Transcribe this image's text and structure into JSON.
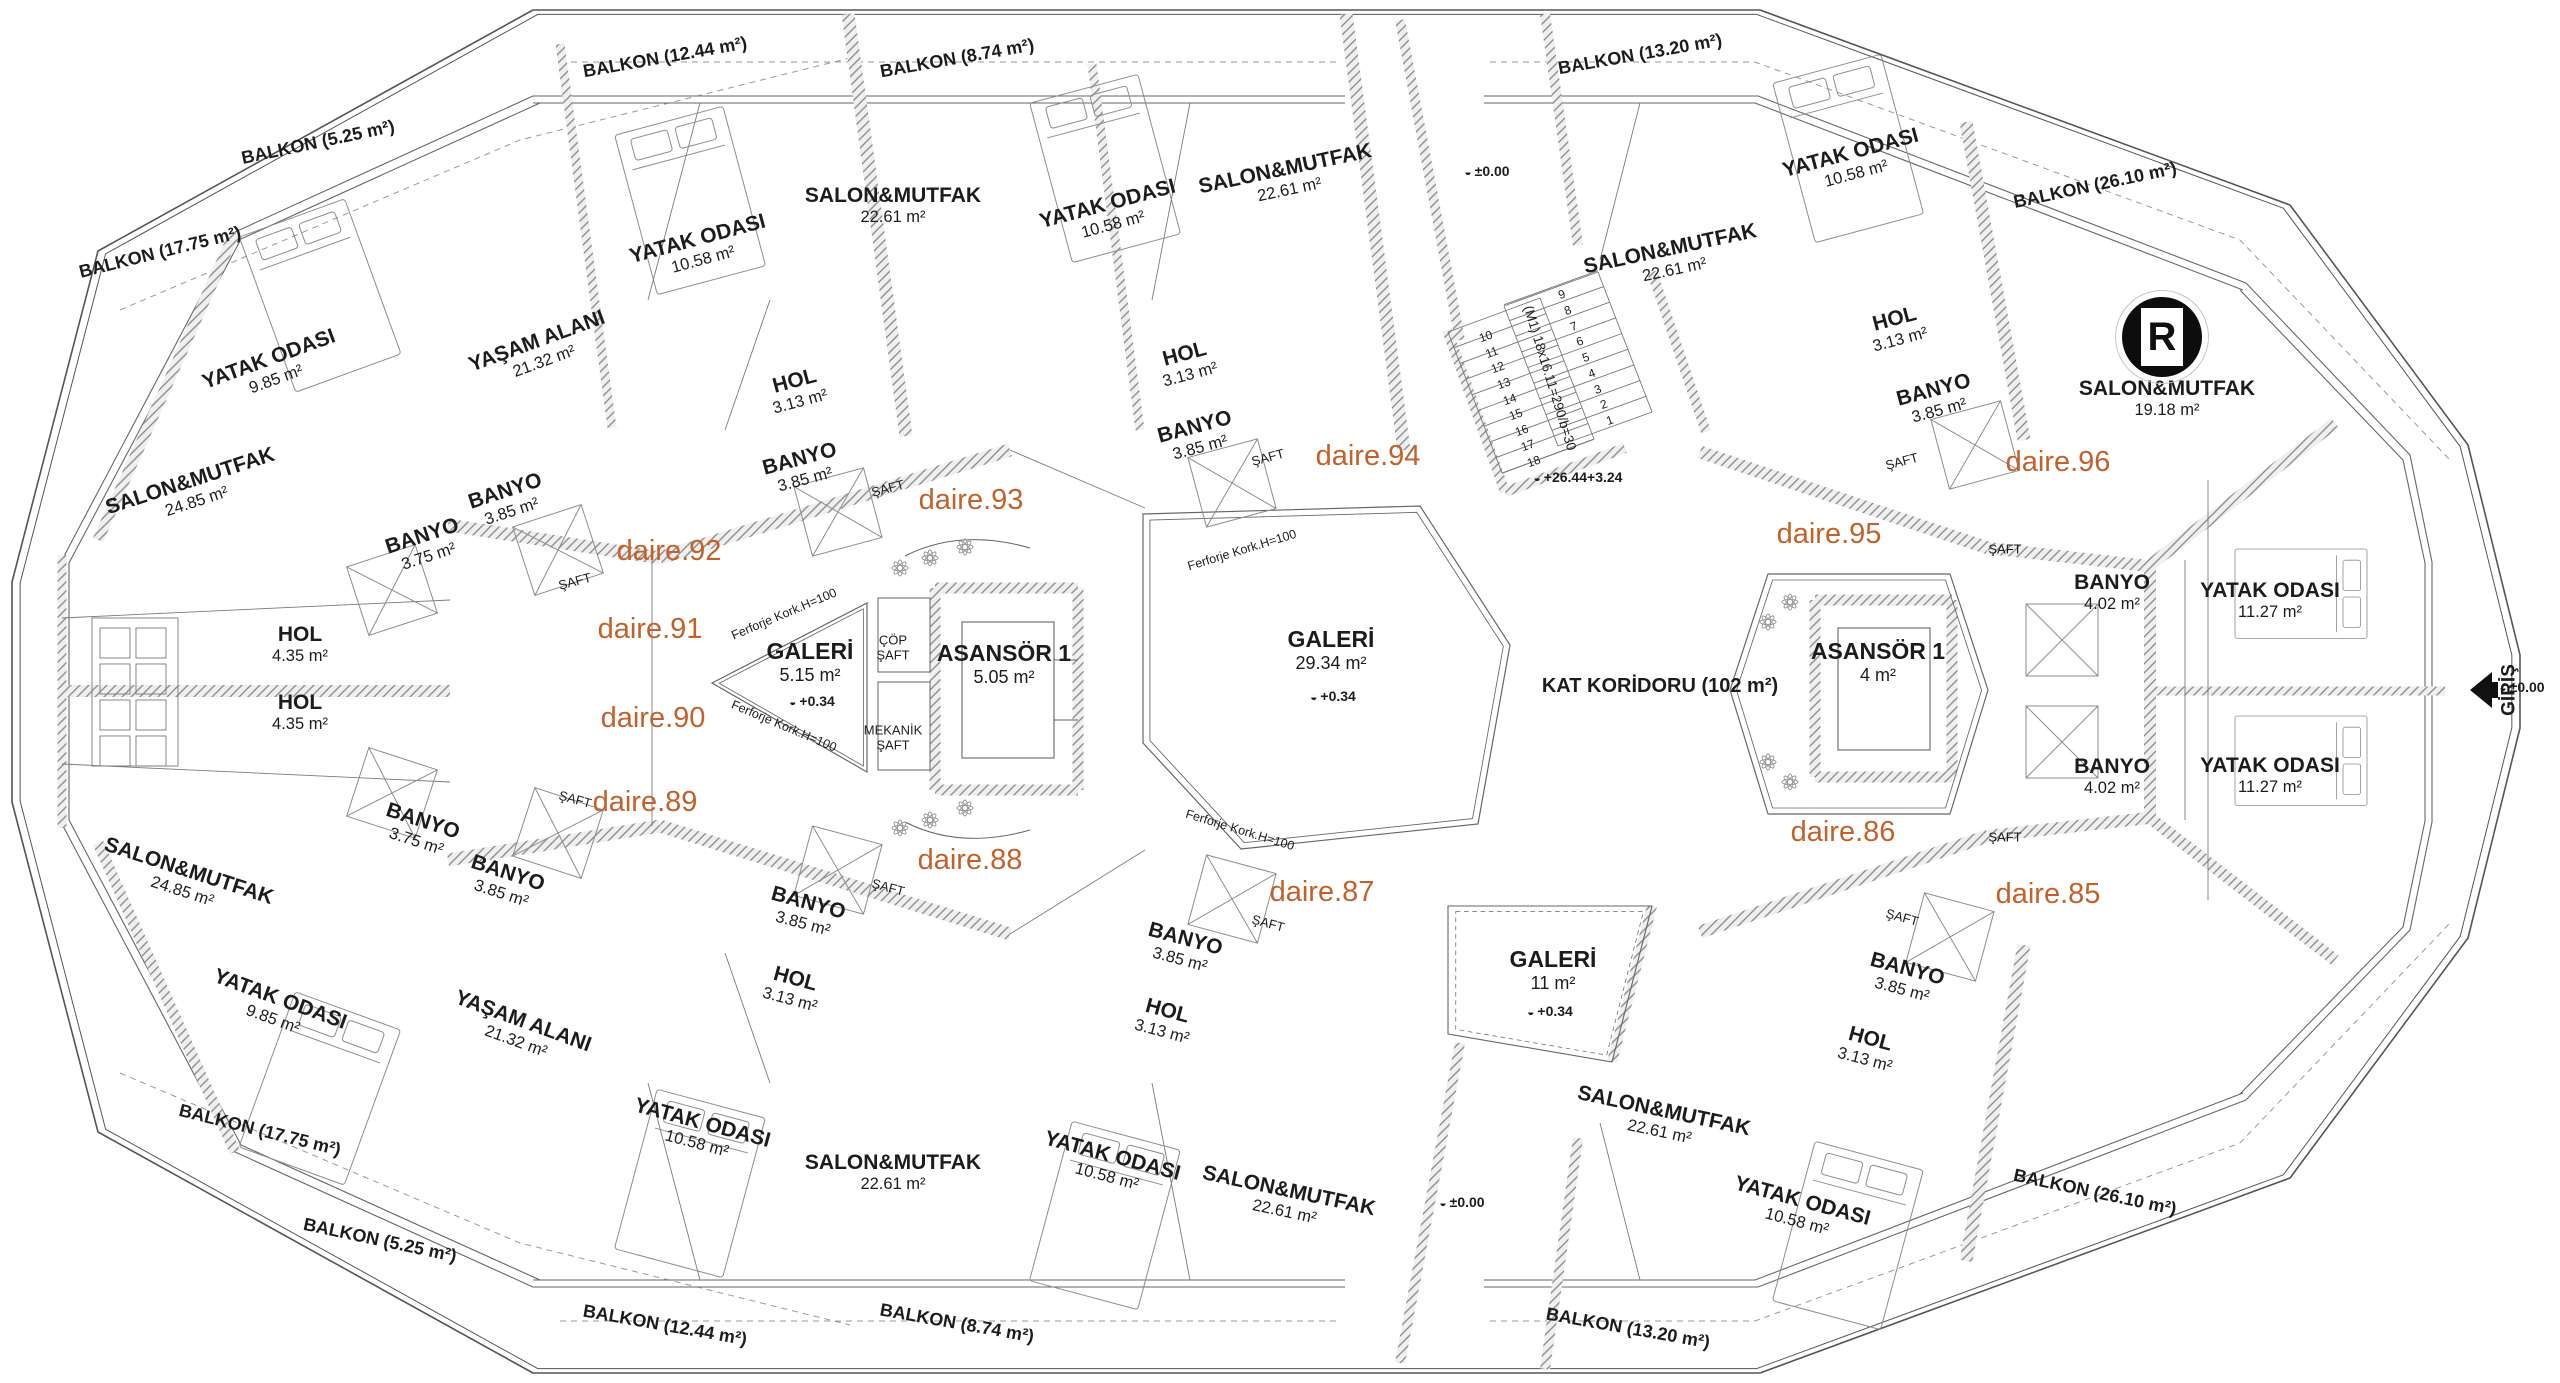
{
  "colors": {
    "accent": "#c2612c",
    "ink": "#1c1c1c",
    "wall": "#8f8f8f"
  },
  "logo": {
    "letter": "R"
  },
  "entrance": {
    "label": "GİRİŞ",
    "elevation": "±0.00"
  },
  "stairs": {
    "note": "(M1) 18x16.11=290/b=30"
  },
  "labels": [
    {
      "c": "room",
      "x": 272,
      "y": 368,
      "r": -20,
      "lines": [
        "YATAK ODASI",
        "9.85 m²"
      ]
    },
    {
      "c": "room",
      "x": 540,
      "y": 350,
      "r": -20,
      "lines": [
        "YAŞAM ALANI",
        "21.32 m²"
      ]
    },
    {
      "c": "room",
      "x": 193,
      "y": 490,
      "r": -18,
      "lines": [
        "SALON&MUTFAK",
        "24.85 m²"
      ]
    },
    {
      "c": "room",
      "x": 425,
      "y": 545,
      "r": -18,
      "lines": [
        "BANYO",
        "3.75 m²"
      ]
    },
    {
      "c": "room",
      "x": 508,
      "y": 500,
      "r": -18,
      "lines": [
        "BANYO",
        "3.85 m²"
      ]
    },
    {
      "c": "room",
      "x": 700,
      "y": 248,
      "r": -15,
      "lines": [
        "YATAK ODASI",
        "10.58 m²"
      ]
    },
    {
      "c": "room",
      "x": 893,
      "y": 205,
      "r": 0,
      "lines": [
        "SALON&MUTFAK",
        "22.61 m²"
      ]
    },
    {
      "c": "room",
      "x": 797,
      "y": 390,
      "r": -15,
      "lines": [
        "HOL",
        "3.13 m²"
      ]
    },
    {
      "c": "room",
      "x": 802,
      "y": 468,
      "r": -15,
      "lines": [
        "BANYO",
        "3.85 m²"
      ]
    },
    {
      "c": "room",
      "x": 1110,
      "y": 213,
      "r": -15,
      "lines": [
        "YATAK ODASI",
        "10.58 m²"
      ]
    },
    {
      "c": "room",
      "x": 1287,
      "y": 178,
      "r": -12,
      "lines": [
        "SALON&MUTFAK",
        "22.61 m²"
      ]
    },
    {
      "c": "room",
      "x": 1187,
      "y": 363,
      "r": -15,
      "lines": [
        "HOL",
        "3.13 m²"
      ]
    },
    {
      "c": "room",
      "x": 1197,
      "y": 436,
      "r": -15,
      "lines": [
        "BANYO",
        "3.85 m²"
      ]
    },
    {
      "c": "room",
      "x": 1672,
      "y": 258,
      "r": -12,
      "lines": [
        "SALON&MUTFAK",
        "22.61 m²"
      ]
    },
    {
      "c": "room",
      "x": 1853,
      "y": 162,
      "r": -15,
      "lines": [
        "YATAK ODASI",
        "10.58 m²"
      ]
    },
    {
      "c": "room",
      "x": 1897,
      "y": 328,
      "r": -15,
      "lines": [
        "HOL",
        "3.13 m²"
      ]
    },
    {
      "c": "room",
      "x": 1936,
      "y": 399,
      "r": -15,
      "lines": [
        "BANYO",
        "3.85 m²"
      ]
    },
    {
      "c": "room",
      "x": 2167,
      "y": 398,
      "r": 0,
      "lines": [
        "SALON&MUTFAK",
        "19.18 m²"
      ]
    },
    {
      "c": "room",
      "x": 2112,
      "y": 592,
      "r": 0,
      "lines": [
        "BANYO",
        "4.02 m²"
      ]
    },
    {
      "c": "room",
      "x": 2270,
      "y": 600,
      "r": 0,
      "lines": [
        "YATAK ODASI",
        "11.27 m²"
      ]
    },
    {
      "c": "room",
      "x": 2112,
      "y": 776,
      "r": 0,
      "lines": [
        "BANYO",
        "4.02 m²"
      ]
    },
    {
      "c": "room",
      "x": 2270,
      "y": 775,
      "r": 0,
      "lines": [
        "YATAK ODASI",
        "11.27 m²"
      ]
    },
    {
      "c": "room",
      "x": 300,
      "y": 644,
      "r": 0,
      "lines": [
        "HOL",
        "4.35 m²"
      ]
    },
    {
      "c": "room",
      "x": 300,
      "y": 712,
      "r": 0,
      "lines": [
        "HOL",
        "4.35 m²"
      ]
    },
    {
      "c": "room",
      "x": 277,
      "y": 1008,
      "r": 20,
      "lines": [
        "YATAK ODASI",
        "9.85 m²"
      ]
    },
    {
      "c": "room",
      "x": 520,
      "y": 1030,
      "r": 20,
      "lines": [
        "YAŞAM ALANI",
        "21.32 m²"
      ]
    },
    {
      "c": "room",
      "x": 186,
      "y": 880,
      "r": 18,
      "lines": [
        "SALON&MUTFAK",
        "24.85 m²"
      ]
    },
    {
      "c": "room",
      "x": 420,
      "y": 830,
      "r": 18,
      "lines": [
        "BANYO",
        "3.75 m²"
      ]
    },
    {
      "c": "room",
      "x": 505,
      "y": 882,
      "r": 18,
      "lines": [
        "BANYO",
        "3.85 m²"
      ]
    },
    {
      "c": "room",
      "x": 700,
      "y": 1132,
      "r": 15,
      "lines": [
        "YATAK ODASI",
        "10.58 m²"
      ]
    },
    {
      "c": "room",
      "x": 893,
      "y": 1172,
      "r": 0,
      "lines": [
        "SALON&MUTFAK",
        "22.61 m²"
      ]
    },
    {
      "c": "room",
      "x": 793,
      "y": 988,
      "r": 15,
      "lines": [
        "HOL",
        "3.13 m²"
      ]
    },
    {
      "c": "room",
      "x": 806,
      "y": 912,
      "r": 15,
      "lines": [
        "BANYO",
        "3.85 m²"
      ]
    },
    {
      "c": "room",
      "x": 1110,
      "y": 1165,
      "r": 15,
      "lines": [
        "YATAK ODASI",
        "10.58 m²"
      ]
    },
    {
      "c": "room",
      "x": 1287,
      "y": 1200,
      "r": 12,
      "lines": [
        "SALON&MUTFAK",
        "22.61 m²"
      ]
    },
    {
      "c": "room",
      "x": 1165,
      "y": 1020,
      "r": 15,
      "lines": [
        "HOL",
        "3.13 m²"
      ]
    },
    {
      "c": "room",
      "x": 1183,
      "y": 948,
      "r": 15,
      "lines": [
        "BANYO",
        "3.85 m²"
      ]
    },
    {
      "c": "room",
      "x": 1662,
      "y": 1120,
      "r": 12,
      "lines": [
        "SALON&MUTFAK",
        "22.61 m²"
      ]
    },
    {
      "c": "room",
      "x": 1800,
      "y": 1210,
      "r": 15,
      "lines": [
        "YATAK ODASI",
        "10.58 m²"
      ]
    },
    {
      "c": "room",
      "x": 1868,
      "y": 1048,
      "r": 15,
      "lines": [
        "HOL",
        "3.13 m²"
      ]
    },
    {
      "c": "room",
      "x": 1905,
      "y": 978,
      "r": 15,
      "lines": [
        "BANYO",
        "3.85 m²"
      ]
    },
    {
      "c": "core",
      "x": 810,
      "y": 662,
      "r": 0,
      "lines": [
        "GALERİ",
        "5.15 m²"
      ]
    },
    {
      "c": "elev",
      "x": 812,
      "y": 702,
      "r": 0,
      "lines": [
        "+0.34"
      ]
    },
    {
      "c": "shaftlbl",
      "x": 893,
      "y": 648,
      "r": 0,
      "lines": [
        "ÇÖP",
        "ŞAFT"
      ]
    },
    {
      "c": "shaftlbl",
      "x": 893,
      "y": 738,
      "r": 0,
      "lines": [
        "MEKANİK",
        "ŞAFT"
      ]
    },
    {
      "c": "core",
      "x": 1004,
      "y": 664,
      "r": 0,
      "lines": [
        "ASANSÖR 1",
        "5.05 m²"
      ]
    },
    {
      "c": "core",
      "x": 1331,
      "y": 650,
      "r": 0,
      "lines": [
        "GALERİ",
        "29.34 m²"
      ]
    },
    {
      "c": "elev",
      "x": 1333,
      "y": 697,
      "r": 0,
      "lines": [
        "+0.34"
      ]
    },
    {
      "c": "kat",
      "x": 1660,
      "y": 686,
      "r": 0,
      "lines": [
        "KAT KORİDORU (102 m²)"
      ]
    },
    {
      "c": "core",
      "x": 1878,
      "y": 662,
      "r": 0,
      "lines": [
        "ASANSÖR 1",
        "4 m²"
      ]
    },
    {
      "c": "core",
      "x": 1553,
      "y": 970,
      "r": 0,
      "lines": [
        "GALERİ",
        "11 m²"
      ]
    },
    {
      "c": "elev",
      "x": 1550,
      "y": 1012,
      "r": 0,
      "lines": [
        "+0.34"
      ]
    },
    {
      "c": "apt",
      "x": 669,
      "y": 551,
      "r": 0,
      "lines": [
        "daire.92"
      ]
    },
    {
      "c": "apt",
      "x": 650,
      "y": 629,
      "r": 0,
      "lines": [
        "daire.91"
      ]
    },
    {
      "c": "apt",
      "x": 653,
      "y": 718,
      "r": 0,
      "lines": [
        "daire.90"
      ]
    },
    {
      "c": "apt",
      "x": 645,
      "y": 802,
      "r": 0,
      "lines": [
        "daire.89"
      ]
    },
    {
      "c": "apt",
      "x": 971,
      "y": 500,
      "r": 0,
      "lines": [
        "daire.93"
      ]
    },
    {
      "c": "apt",
      "x": 970,
      "y": 860,
      "r": 0,
      "lines": [
        "daire.88"
      ]
    },
    {
      "c": "apt",
      "x": 1368,
      "y": 456,
      "r": 0,
      "lines": [
        "daire.94"
      ]
    },
    {
      "c": "apt",
      "x": 1322,
      "y": 892,
      "r": 0,
      "lines": [
        "daire.87"
      ]
    },
    {
      "c": "apt",
      "x": 1829,
      "y": 534,
      "r": 0,
      "lines": [
        "daire.95"
      ]
    },
    {
      "c": "apt",
      "x": 1843,
      "y": 832,
      "r": 0,
      "lines": [
        "daire.86"
      ]
    },
    {
      "c": "apt",
      "x": 2058,
      "y": 462,
      "r": 0,
      "lines": [
        "daire.96"
      ]
    },
    {
      "c": "apt",
      "x": 2048,
      "y": 894,
      "r": 0,
      "lines": [
        "daire.85"
      ]
    },
    {
      "c": "balk",
      "x": 665,
      "y": 57,
      "r": -10,
      "lines": [
        "BALKON (12.44 m²)"
      ]
    },
    {
      "c": "balk",
      "x": 957,
      "y": 58,
      "r": -10,
      "lines": [
        "BALKON (8.74 m²)"
      ]
    },
    {
      "c": "balk",
      "x": 1640,
      "y": 54,
      "r": -10,
      "lines": [
        "BALKON (13.20 m²)"
      ]
    },
    {
      "c": "balk",
      "x": 318,
      "y": 142,
      "r": -12,
      "lines": [
        "BALKON (5.25 m²)"
      ]
    },
    {
      "c": "balk",
      "x": 160,
      "y": 252,
      "r": -14,
      "lines": [
        "BALKON (17.75 m²)"
      ]
    },
    {
      "c": "balk",
      "x": 2095,
      "y": 185,
      "r": -12,
      "lines": [
        "BALKON (26.10 m²)"
      ]
    },
    {
      "c": "balk",
      "x": 665,
      "y": 1325,
      "r": 10,
      "lines": [
        "BALKON (12.44 m²)"
      ]
    },
    {
      "c": "balk",
      "x": 957,
      "y": 1323,
      "r": 10,
      "lines": [
        "BALKON (8.74 m²)"
      ]
    },
    {
      "c": "balk",
      "x": 1628,
      "y": 1328,
      "r": 10,
      "lines": [
        "BALKON (13.20 m²)"
      ]
    },
    {
      "c": "balk",
      "x": 380,
      "y": 1240,
      "r": 12,
      "lines": [
        "BALKON (5.25 m²)"
      ]
    },
    {
      "c": "balk",
      "x": 260,
      "y": 1130,
      "r": 14,
      "lines": [
        "BALKON (17.75 m²)"
      ]
    },
    {
      "c": "balk",
      "x": 2095,
      "y": 1192,
      "r": 12,
      "lines": [
        "BALKON (26.10 m²)"
      ]
    },
    {
      "c": "shaft",
      "x": 575,
      "y": 582,
      "r": -15,
      "lines": [
        "ŞAFT"
      ]
    },
    {
      "c": "shaft",
      "x": 888,
      "y": 489,
      "r": -15,
      "lines": [
        "ŞAFT"
      ]
    },
    {
      "c": "shaft",
      "x": 1268,
      "y": 458,
      "r": -15,
      "lines": [
        "ŞAFT"
      ]
    },
    {
      "c": "shaft",
      "x": 1902,
      "y": 462,
      "r": -15,
      "lines": [
        "ŞAFT"
      ]
    },
    {
      "c": "shaft",
      "x": 2005,
      "y": 550,
      "r": 0,
      "lines": [
        "ŞAFT"
      ]
    },
    {
      "c": "shaft",
      "x": 575,
      "y": 800,
      "r": 15,
      "lines": [
        "ŞAFT"
      ]
    },
    {
      "c": "shaft",
      "x": 888,
      "y": 888,
      "r": 15,
      "lines": [
        "ŞAFT"
      ]
    },
    {
      "c": "shaft",
      "x": 1268,
      "y": 924,
      "r": 15,
      "lines": [
        "ŞAFT"
      ]
    },
    {
      "c": "shaft",
      "x": 1902,
      "y": 918,
      "r": 15,
      "lines": [
        "ŞAFT"
      ]
    },
    {
      "c": "shaft",
      "x": 2005,
      "y": 838,
      "r": 0,
      "lines": [
        "ŞAFT"
      ]
    },
    {
      "c": "fer",
      "x": 784,
      "y": 614,
      "r": -23,
      "lines": [
        "Ferforje Kork.H=100"
      ]
    },
    {
      "c": "fer",
      "x": 784,
      "y": 726,
      "r": 23,
      "lines": [
        "Ferforje Kork.H=100"
      ]
    },
    {
      "c": "fer",
      "x": 1242,
      "y": 550,
      "r": -17,
      "lines": [
        "Ferforje Kork.H=100"
      ]
    },
    {
      "c": "fer",
      "x": 1240,
      "y": 830,
      "r": 17,
      "lines": [
        "Ferforje Kork.H=100"
      ]
    },
    {
      "c": "elev",
      "x": 1487,
      "y": 172,
      "r": 0,
      "lines": [
        "±0.00"
      ]
    },
    {
      "c": "elev",
      "x": 1462,
      "y": 1203,
      "r": 0,
      "lines": [
        "±0.00"
      ]
    },
    {
      "c": "elev",
      "x": 2522,
      "y": 688,
      "r": 0,
      "lines": [
        "±0.00"
      ]
    },
    {
      "c": "elev",
      "x": 1578,
      "y": 478,
      "r": 0,
      "lines": [
        "+26.44",
        "+3.24"
      ]
    },
    {
      "c": "note",
      "x": 1550,
      "y": 378,
      "r": 73,
      "lines": [
        "(M1) 18x16.11=290/b=30"
      ]
    },
    {
      "c": "giris",
      "x": 2509,
      "y": 690,
      "r": -90,
      "lines": [
        "GİRİŞ"
      ]
    },
    {
      "c": "num",
      "x": 1610,
      "y": 421,
      "r": -20,
      "lines": [
        "1"
      ]
    },
    {
      "c": "num",
      "x": 1604,
      "y": 405,
      "r": -20,
      "lines": [
        "2"
      ]
    },
    {
      "c": "num",
      "x": 1598,
      "y": 390,
      "r": -20,
      "lines": [
        "3"
      ]
    },
    {
      "c": "num",
      "x": 1592,
      "y": 374,
      "r": -20,
      "lines": [
        "4"
      ]
    },
    {
      "c": "num",
      "x": 1586,
      "y": 358,
      "r": -20,
      "lines": [
        "5"
      ]
    },
    {
      "c": "num",
      "x": 1580,
      "y": 342,
      "r": -20,
      "lines": [
        "6"
      ]
    },
    {
      "c": "num",
      "x": 1574,
      "y": 327,
      "r": -20,
      "lines": [
        "7"
      ]
    },
    {
      "c": "num",
      "x": 1568,
      "y": 311,
      "r": -20,
      "lines": [
        "8"
      ]
    },
    {
      "c": "num",
      "x": 1562,
      "y": 295,
      "r": -20,
      "lines": [
        "9"
      ]
    },
    {
      "c": "num",
      "x": 1486,
      "y": 337,
      "r": -20,
      "lines": [
        "10"
      ]
    },
    {
      "c": "num",
      "x": 1492,
      "y": 353,
      "r": -20,
      "lines": [
        "11"
      ]
    },
    {
      "c": "num",
      "x": 1498,
      "y": 368,
      "r": -20,
      "lines": [
        "12"
      ]
    },
    {
      "c": "num",
      "x": 1504,
      "y": 384,
      "r": -20,
      "lines": [
        "13"
      ]
    },
    {
      "c": "num",
      "x": 1510,
      "y": 400,
      "r": -20,
      "lines": [
        "14"
      ]
    },
    {
      "c": "num",
      "x": 1516,
      "y": 415,
      "r": -20,
      "lines": [
        "15"
      ]
    },
    {
      "c": "num",
      "x": 1522,
      "y": 431,
      "r": -20,
      "lines": [
        "16"
      ]
    },
    {
      "c": "num",
      "x": 1528,
      "y": 446,
      "r": -20,
      "lines": [
        "17"
      ]
    },
    {
      "c": "num",
      "x": 1534,
      "y": 462,
      "r": -20,
      "lines": [
        "18"
      ]
    }
  ]
}
